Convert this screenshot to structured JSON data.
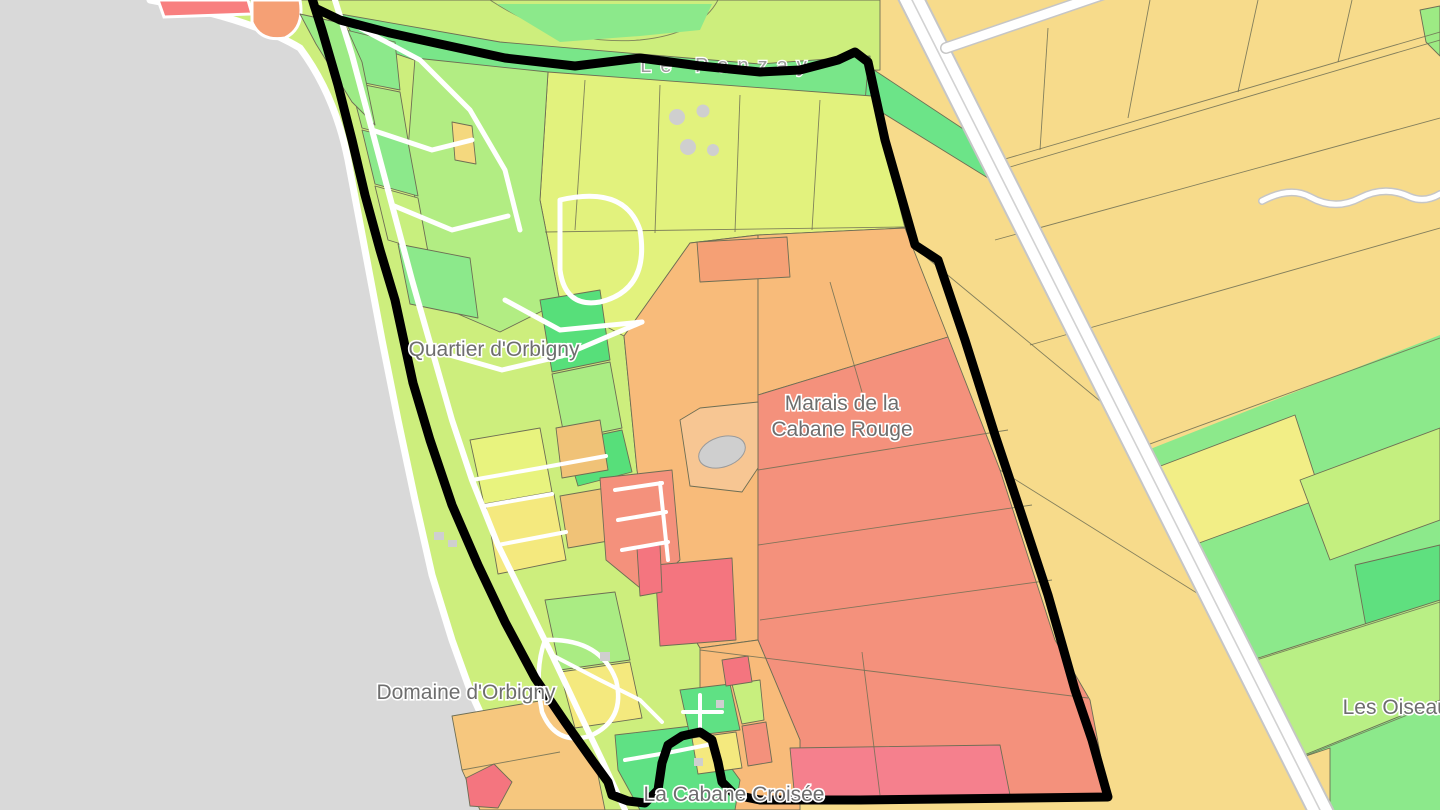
{
  "map": {
    "labels": {
      "stream": "Le Panzay",
      "quartier": "Quartier d'Orbigny",
      "marais_line1": "Marais de la",
      "marais_line2": "Cabane Rouge",
      "domaine": "Domaine d'Orbigny",
      "cabane": "La Cabane Croisée",
      "oiseaux": "Les Oiseaux"
    },
    "palette": {
      "beach_gray": "#d9d9d9",
      "field_gold": "#f7db8b",
      "field_yellow": "#f4e97e",
      "field_yellow_green": "#cdee7d",
      "field_light_green": "#b2ed83",
      "field_green": "#8ce98b",
      "field_bright_green": "#5fe184",
      "parcel_orange": "#f8bb7a",
      "parcel_salmon": "#f4917c",
      "parcel_red": "#f4757f",
      "parcel_pink": "#f5808d",
      "boundary_black": "#000000",
      "road_white": "#ffffff",
      "road_casing": "#c6c6c6",
      "label_gray": "#6e6e6e"
    }
  }
}
